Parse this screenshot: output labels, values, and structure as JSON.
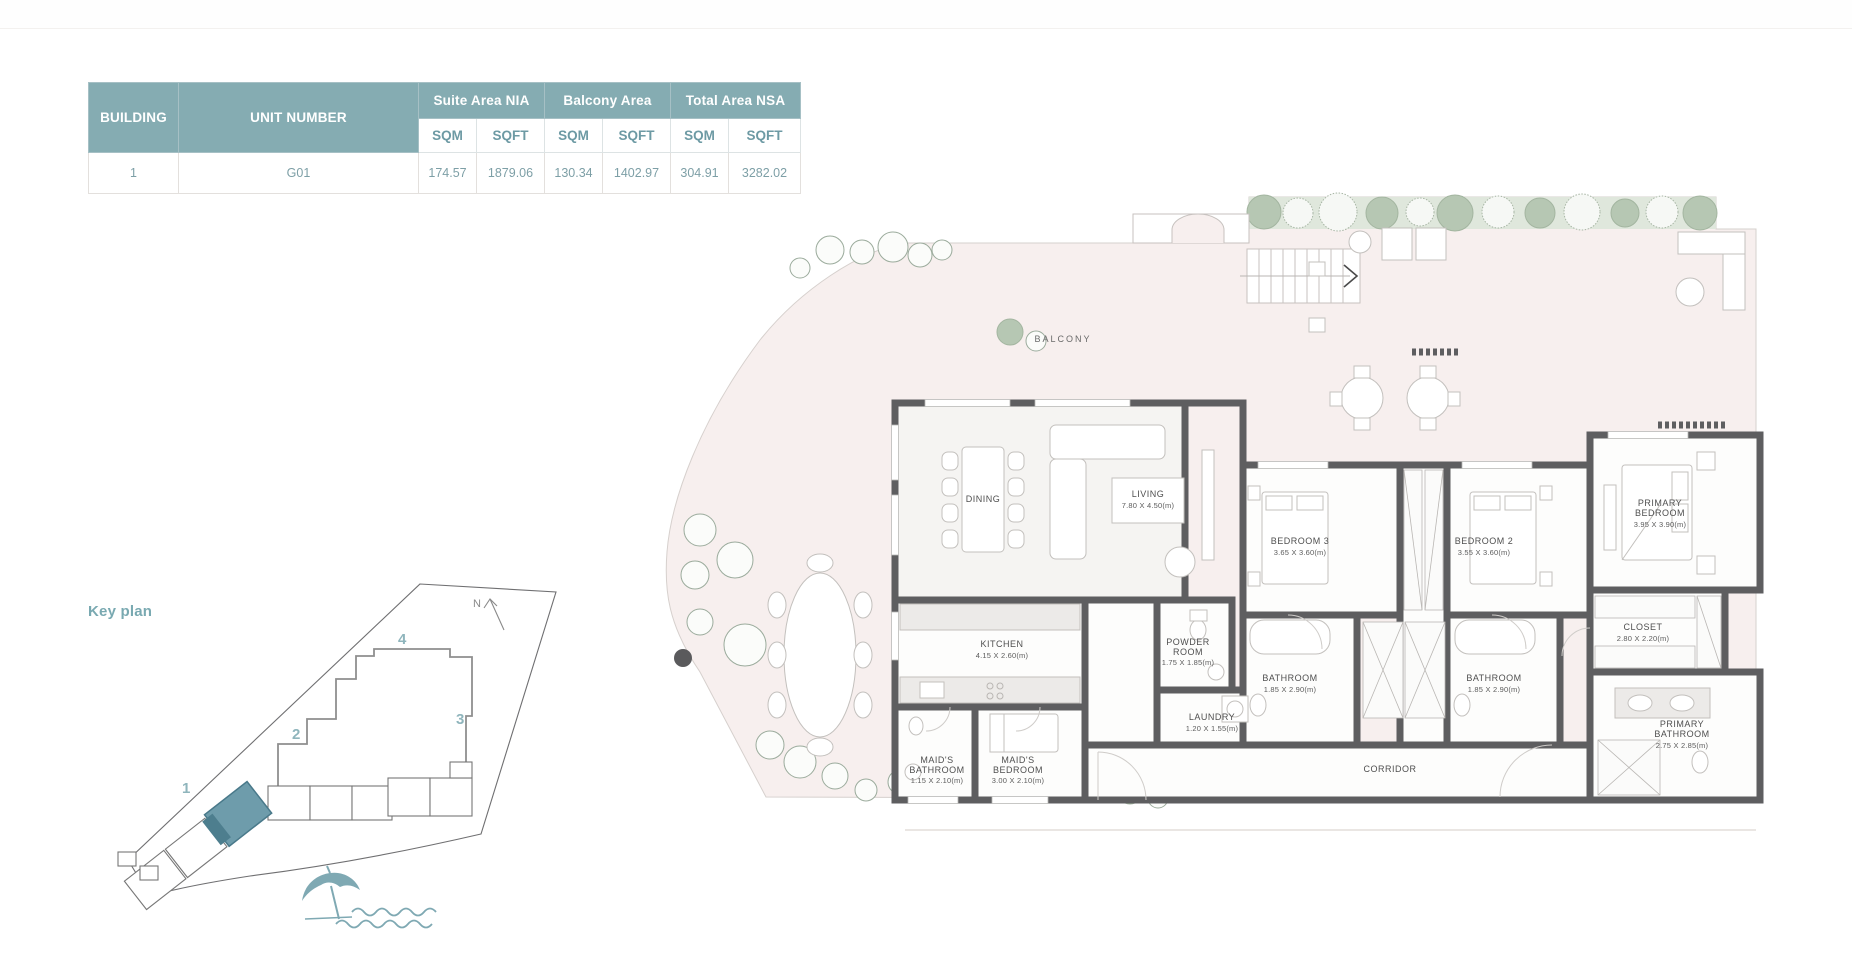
{
  "table": {
    "col_building": "BUILDING",
    "col_unit": "UNIT NUMBER",
    "group_headers": [
      "Suite Area NIA",
      "Balcony Area",
      "Total Area NSA"
    ],
    "sub_headers": [
      "SQM",
      "SQFT",
      "SQM",
      "SQFT",
      "SQM",
      "SQFT"
    ],
    "rows": [
      {
        "building": "1",
        "unit": "G01",
        "values": [
          "174.57",
          "1879.06",
          "130.34",
          "1402.97",
          "304.91",
          "3282.02"
        ]
      }
    ]
  },
  "key_plan": {
    "title": "Key plan",
    "north": "N",
    "numbers": {
      "b1": "1",
      "b2": "2",
      "b3": "3",
      "b4": "4"
    }
  },
  "plan": {
    "balcony": "BALCONY",
    "corridor": "CORRIDOR",
    "rooms": {
      "dining": {
        "name": "DINING"
      },
      "living": {
        "name": "LIVING",
        "dims": "7.80 X 4.50(m)"
      },
      "kitchen": {
        "name": "KITCHEN",
        "dims": "4.15 X 2.60(m)"
      },
      "powder": {
        "line1": "POWDER",
        "line2": "ROOM",
        "dims": "1.75 X 1.85(m)"
      },
      "laundry": {
        "name": "LAUNDRY",
        "dims": "1.20 X 1.55(m)"
      },
      "maids_bath": {
        "line1": "MAID'S",
        "line2": "BATHROOM",
        "dims": "1.15 X 2.10(m)"
      },
      "maids_bed": {
        "line1": "MAID'S",
        "line2": "BEDROOM",
        "dims": "3.00 X 2.10(m)"
      },
      "bedroom3": {
        "name": "BEDROOM 3",
        "dims": "3.65 X 3.60(m)"
      },
      "bedroom2": {
        "name": "BEDROOM 2",
        "dims": "3.55 X 3.60(m)"
      },
      "bathroom3": {
        "name": "BATHROOM",
        "dims": "1.85 X 2.90(m)"
      },
      "bathroom2": {
        "name": "BATHROOM",
        "dims": "1.85 X 2.90(m)"
      },
      "primary_bedroom": {
        "line1": "PRIMARY",
        "line2": "BEDROOM",
        "dims": "3.95 X 3.90(m)"
      },
      "closet": {
        "name": "CLOSET",
        "dims": "2.80 X 2.20(m)"
      },
      "primary_bathroom": {
        "line1": "PRIMARY",
        "line2": "BATHROOM",
        "dims": "2.75 X 2.85(m)"
      }
    }
  },
  "colors": {
    "accent_teal": "#85acb2",
    "table_value_text": "#7d9fa6",
    "keyplan_accent": "#8fb5bc",
    "highlight_unit": "#6e9cab",
    "balcony_floor": "#f7efee",
    "wall": "#5e5e60",
    "tree_strip": "#dfe7dc",
    "umbrella": "#7fa9b3"
  }
}
